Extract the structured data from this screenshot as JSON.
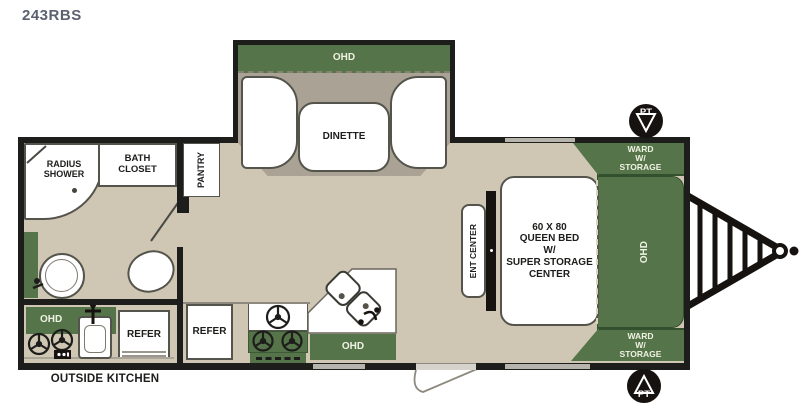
{
  "title": "243RBS",
  "colors": {
    "accent_green": "#557449",
    "floor_tan": "#cfc7b3",
    "slide_floor_gray": "#a9a295",
    "wall_black": "#1d1d1b",
    "title_gray": "#5b6170"
  },
  "slide": {
    "ohd": "OHD",
    "dinette": "DINETTE"
  },
  "bathroom": {
    "shower": "RADIUS\nSHOWER",
    "closet": "BATH\nCLOSET",
    "pantry": "PANTRY"
  },
  "outside_kitchen": {
    "ohd": "OHD",
    "refer": "REFER",
    "caption": "OUTSIDE KITCHEN"
  },
  "kitchen": {
    "refer": "REFER",
    "ohd": "OHD"
  },
  "bedroom": {
    "ent_center": "ENT CENTER",
    "bed": "60 X 80\nQUEEN BED\nW/\nSUPER STORAGE\nCENTER",
    "ohd": "OHD",
    "ward_top": "WARD\nW/\nSTORAGE",
    "ward_bottom": "WARD\nW/\nSTORAGE"
  },
  "markers": {
    "pt_top": "PT",
    "pt_bottom": "PT"
  }
}
